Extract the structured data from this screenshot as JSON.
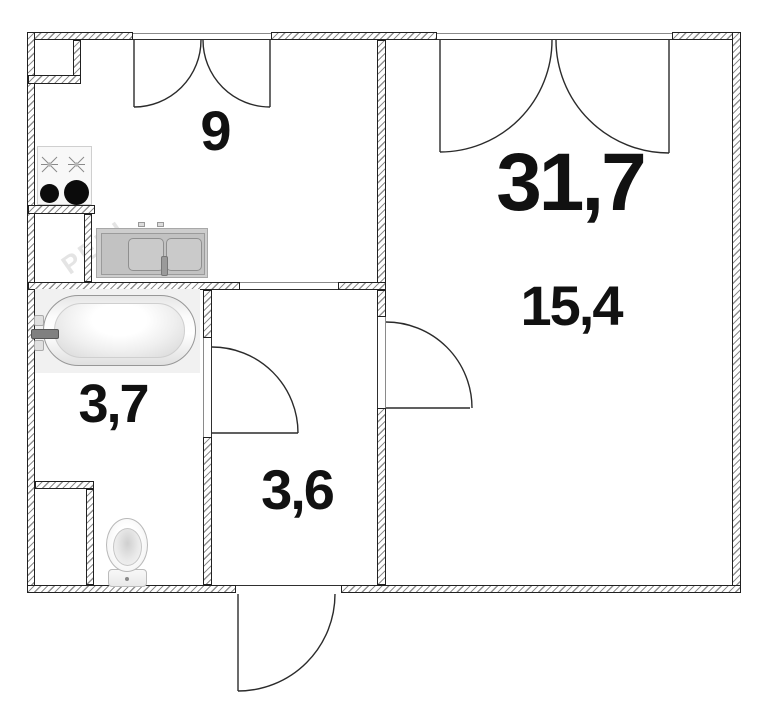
{
  "title": "apartment floor plan",
  "palette": {
    "wall_outline": "#212121",
    "hatch": "#8f8f8f",
    "label": "#111111",
    "door_stroke": "#2b2b2b"
  },
  "rooms": {
    "kitchen": {
      "area": "9"
    },
    "living_total": {
      "area": "31,7"
    },
    "living": {
      "area": "15,4"
    },
    "bathroom": {
      "area": "3,7"
    },
    "hallway": {
      "area": "3,6"
    }
  },
  "fixtures": [
    "stove",
    "sink",
    "bathtub",
    "toilet"
  ],
  "watermark": "PERI"
}
